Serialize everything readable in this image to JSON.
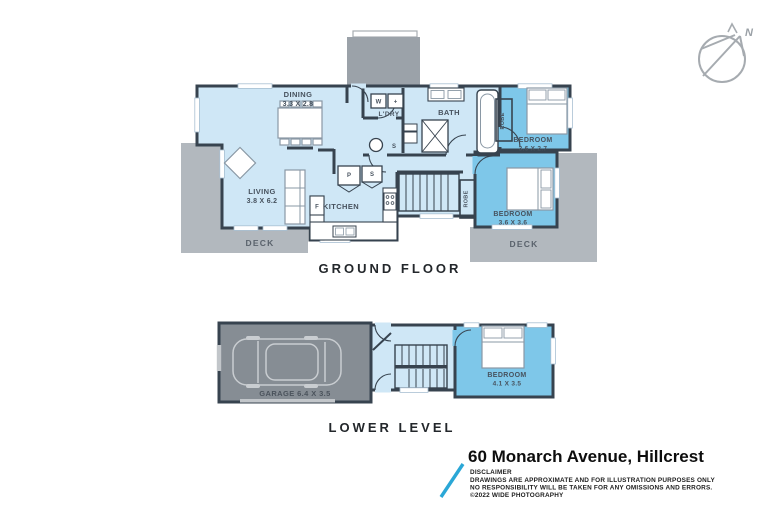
{
  "compass": {
    "north": "N"
  },
  "ground_floor": {
    "title": "GROUND FLOOR",
    "dining": {
      "name": "DINING",
      "dims": "3.3 X 2.8"
    },
    "living": {
      "name": "LIVING",
      "dims": "3.8 X 6.2"
    },
    "kitchen": {
      "name": "KITCHEN",
      "fridge": "F",
      "pantry": "P",
      "shelf": "S"
    },
    "laundry": {
      "name": "L'DRY",
      "washer": "W",
      "dryer": "+",
      "shelf": "S"
    },
    "bath": {
      "name": "BATH"
    },
    "bedroom_top": {
      "name": "BEDROOM",
      "dims": "3.6 X 2.7",
      "robe": "ROBE"
    },
    "bedroom_bottom": {
      "name": "BEDROOM",
      "dims": "3.6 X 3.6",
      "robe": "ROBE"
    },
    "deck_left": {
      "name": "DECK"
    },
    "deck_right": {
      "name": "DECK"
    }
  },
  "lower_level": {
    "title": "LOWER LEVEL",
    "garage": {
      "label": "GARAGE 6.4 X 3.5"
    },
    "bedroom": {
      "name": "BEDROOM",
      "dims": "4.1 X 3.5"
    }
  },
  "footer": {
    "address": "60 Monarch Avenue, Hillcrest",
    "disclaimer_title": "DISCLAIMER",
    "disclaimer_line1": "DRAWINGS ARE APPROXIMATE AND FOR ILLUSTRATION PURPOSES ONLY",
    "disclaimer_line2": "NO RESPONSIBILITY WILL BE TAKEN FOR ANY OMISSIONS AND ERRORS.",
    "disclaimer_line3": "©2022 WIDE PHOTOGRAPHY"
  },
  "colors": {
    "room_light": "#cfe7f6",
    "bedroom_blue": "#7ec7e9",
    "wall": "#37434f",
    "deck_gray": "#b2b8be",
    "garage_gray": "#868d94",
    "porch_gray": "#9ba2a9",
    "logo_blue": "#2aa7d6"
  }
}
